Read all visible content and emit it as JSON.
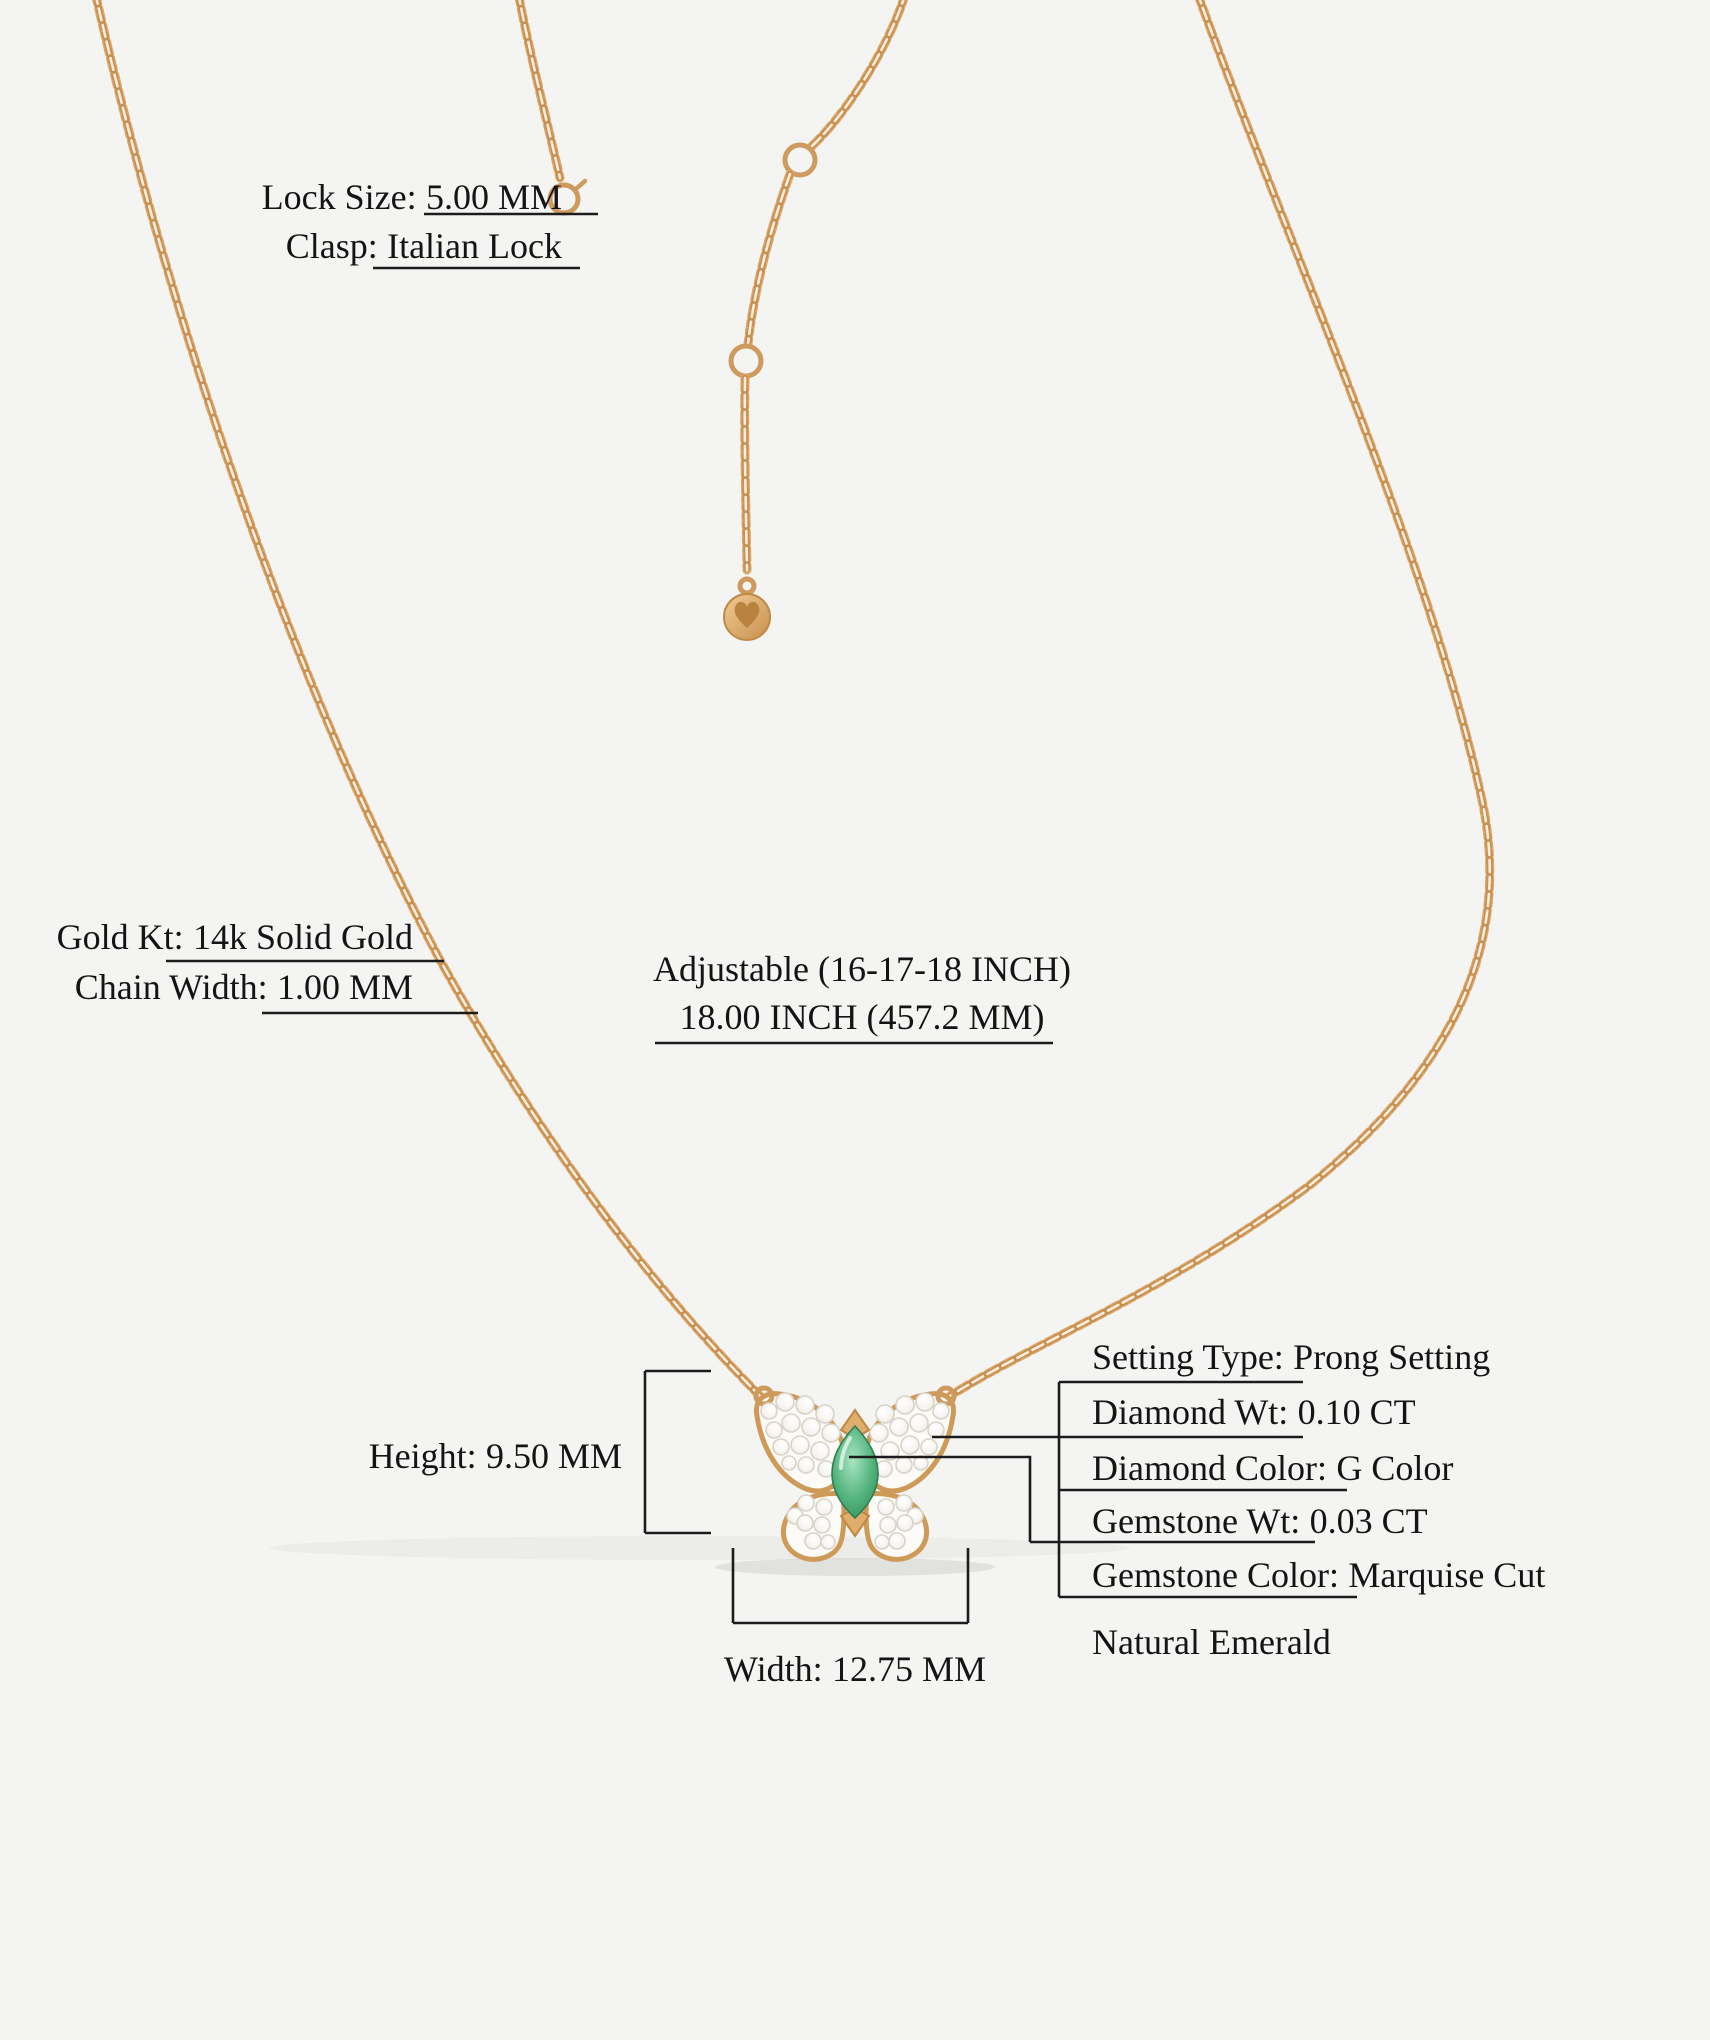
{
  "background": "#f4f4f2",
  "colors": {
    "gold": "#dba76b",
    "gold_dark": "#c89051",
    "gold_light": "#f7eddd",
    "emerald": "#3fa46c",
    "diamond": "#ffffff",
    "text": "#141414",
    "leader_line": "#1c1c1c"
  },
  "annotations": {
    "lock_size": {
      "label": "Lock Size:",
      "value": "5.00 MM"
    },
    "clasp": {
      "label": "Clasp:",
      "value": "Italian Lock"
    },
    "gold_kt": {
      "label": "Gold Kt:",
      "value": "14k Solid Gold"
    },
    "chain_width": {
      "label": "Chain Width:",
      "value": "1.00 MM"
    },
    "adjustable": {
      "line1": "Adjustable (16-17-18 INCH)",
      "line2": "18.00 INCH (457.2 MM)"
    },
    "height": {
      "label": "Height:",
      "value": "9.50 MM"
    },
    "width": {
      "label": "Width:",
      "value": "12.75 MM"
    }
  },
  "specs": [
    {
      "label": "Setting Type:",
      "value": "Prong Setting"
    },
    {
      "label": "Diamond Wt:",
      "value": "0.10 CT"
    },
    {
      "label": "Diamond Color:",
      "value": "G Color"
    },
    {
      "label": "Gemstone Wt:",
      "value": "0.03 CT"
    },
    {
      "label": "Gemstone Color:",
      "value": "Marquise Cut"
    }
  ],
  "specs_note": "Natural Emerald",
  "icons": {
    "necklace_chain": "necklace-chain",
    "spring_ring_clasp": "spring-ring-clasp-icon",
    "extender_ring": "extender-ring-icon",
    "brand_disc_charm": "brand-disc-charm-icon",
    "heart": "heart-icon",
    "butterfly_pendant": "butterfly-pendant",
    "marquise_emerald": "marquise-emerald-gem"
  }
}
